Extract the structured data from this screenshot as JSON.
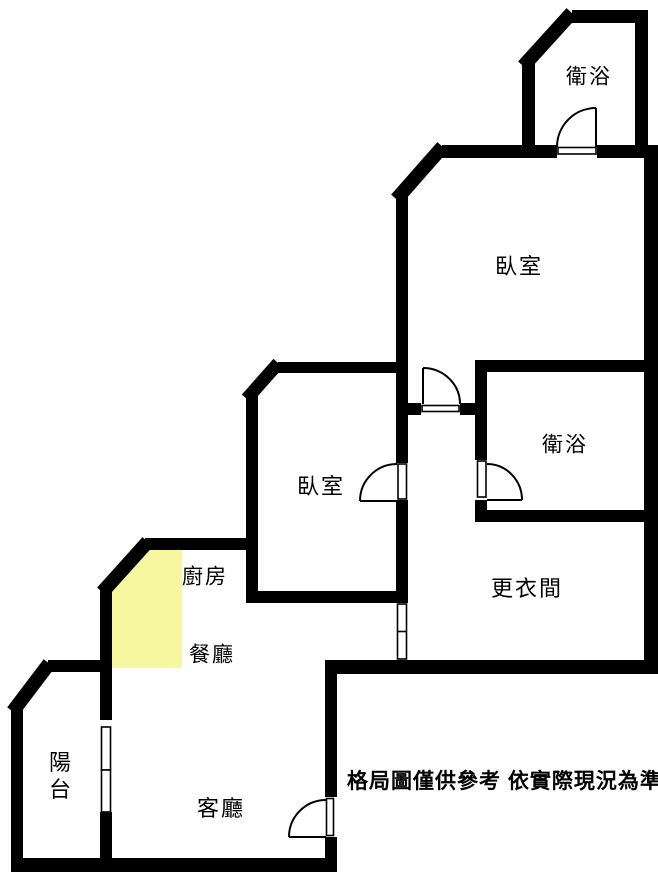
{
  "colors": {
    "wall": "#000000",
    "background": "#ffffff",
    "kitchen_highlight": "#f7f7a0"
  },
  "rooms": {
    "bathroom_top": {
      "label": "衛浴"
    },
    "bedroom_right": {
      "label": "臥室"
    },
    "bathroom_middle": {
      "label": "衛浴"
    },
    "closet": {
      "label": "更衣間"
    },
    "bedroom_center": {
      "label": "臥室"
    },
    "kitchen": {
      "label": "廚房"
    },
    "dining": {
      "label": "餐廳"
    },
    "living": {
      "label": "客廳"
    },
    "balcony": {
      "label": "陽台"
    }
  },
  "disclaimer": "格局圖僅供參考 依實際現況為準"
}
